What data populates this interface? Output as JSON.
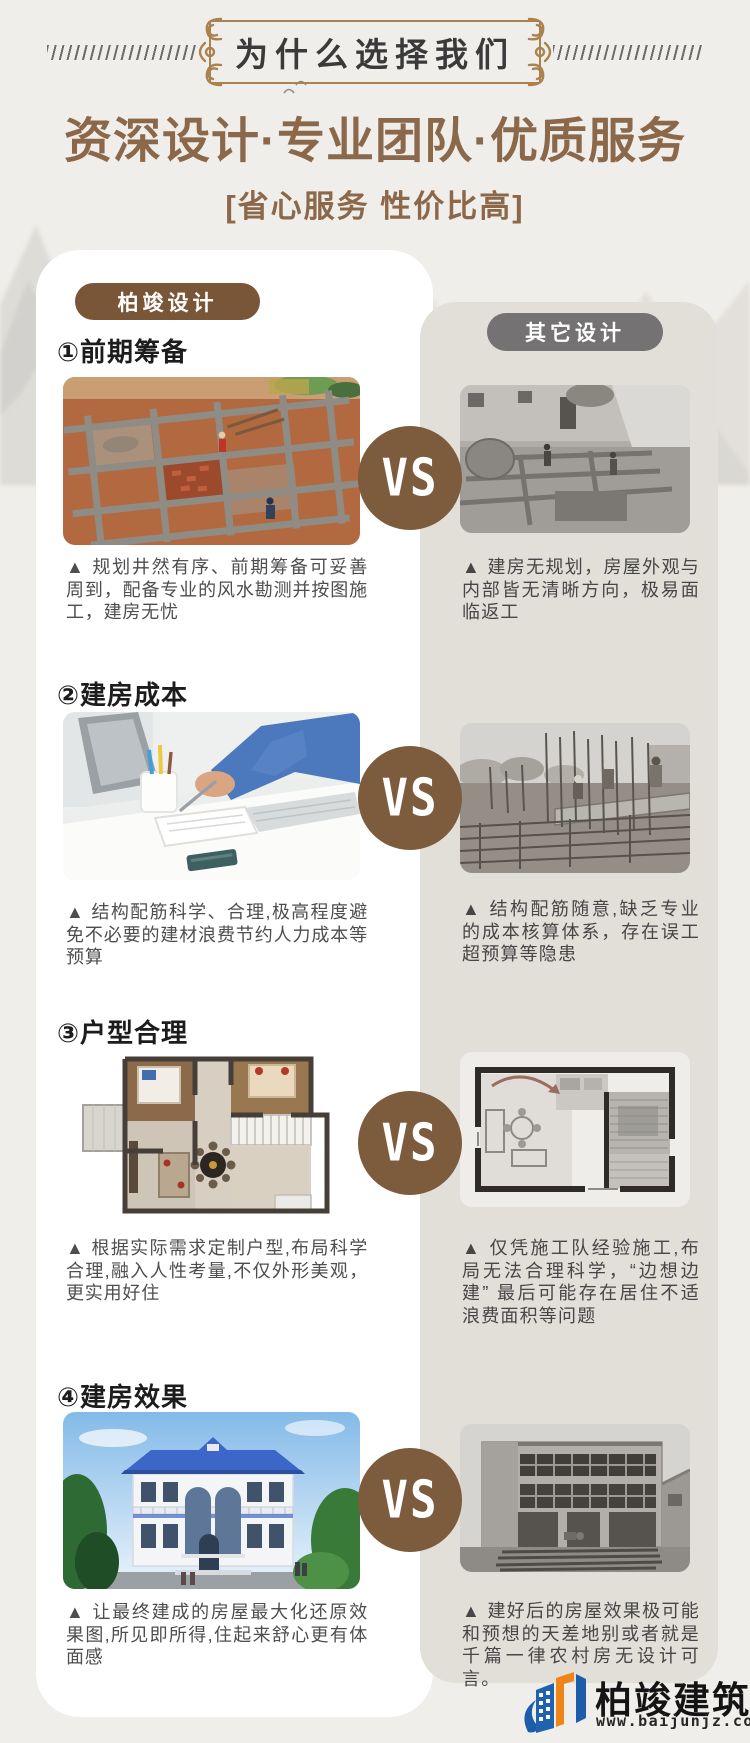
{
  "header": {
    "banner_title": "为什么选择我们",
    "title": "资深设计·专业团队·优质服务",
    "subtitle": "[省心服务 性价比高]"
  },
  "comparison": {
    "left_badge": "柏竣设计",
    "right_badge": "其它设计",
    "vs_label": "VS",
    "sections": [
      {
        "heading": "①前期筹备",
        "left_text": "▲ 规划井然有序、前期筹备可妥善周到，配备专业的风水勘测并按图施工，建房无忧",
        "right_text": "▲ 建房无规划，房屋外观与内部皆无清晰方向，极易面临返工"
      },
      {
        "heading": "②建房成本",
        "left_text": "▲ 结构配筋科学、合理,极高程度避免不必要的建材浪费节约人力成本等预算",
        "right_text": "▲ 结构配筋随意,缺乏专业的成本核算体系，存在误工超预算等隐患"
      },
      {
        "heading": "③户型合理",
        "left_text": "▲ 根据实际需求定制户型,布局科学合理,融入人性考量,不仅外形美观，更实用好住",
        "right_text": "▲ 仅凭施工队经验施工,布局无法合理科学，“边想边建” 最后可能存在居住不适浪费面积等问题"
      },
      {
        "heading": "④建房效果",
        "left_text": "▲ 让最终建成的房屋最大化还原效果图,所见即所得,住起来舒心更有体面感",
        "right_text": "▲ 建好后的房屋效果极可能和预想的天差地别或者就是千篇一律农村房无设计可言。"
      }
    ]
  },
  "footer": {
    "company": "柏竣建筑",
    "website": "www.baijunjz.com"
  },
  "colors": {
    "accent_brown": "#8b6849",
    "badge_brown": "#7a5638",
    "badge_gray": "#747272",
    "panel_beige": "#e2ded8",
    "vs_circle": "#7d5b3d",
    "logo_blue": "#1d5ca8",
    "logo_orange": "#ef8418"
  }
}
